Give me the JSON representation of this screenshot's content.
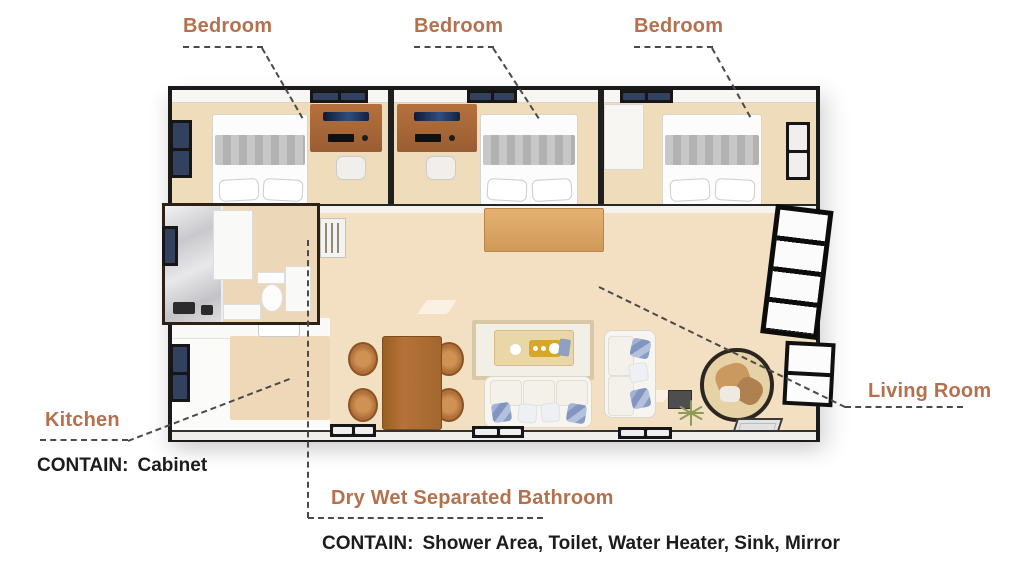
{
  "colors": {
    "accent": "#b5714e",
    "text": "#1c1c1c",
    "leader": "#4a4a4a",
    "floor_tan": "#f2dec1",
    "bedroom_floor": "#efdcba",
    "wood": "#a96a38",
    "wall_dark": "#1a1a1a",
    "window_glass": "#31415e",
    "marble": "#d8d8da",
    "pillow_blue": "#8a9cc6",
    "tray_yellow": "#d7a62b"
  },
  "annotations": {
    "bedrooms": [
      {
        "label": "Bedroom"
      },
      {
        "label": "Bedroom"
      },
      {
        "label": "Bedroom"
      }
    ],
    "kitchen": {
      "label": "Kitchen",
      "contain_prefix": "CONTAIN:",
      "contain_items": "Cabinet"
    },
    "bathroom": {
      "label": "Dry Wet Separated Bathroom",
      "contain_prefix": "CONTAIN:",
      "contain_items": "Shower Area, Toilet, Water Heater, Sink, Mirror"
    },
    "living_room": {
      "label": "Living Room"
    }
  }
}
